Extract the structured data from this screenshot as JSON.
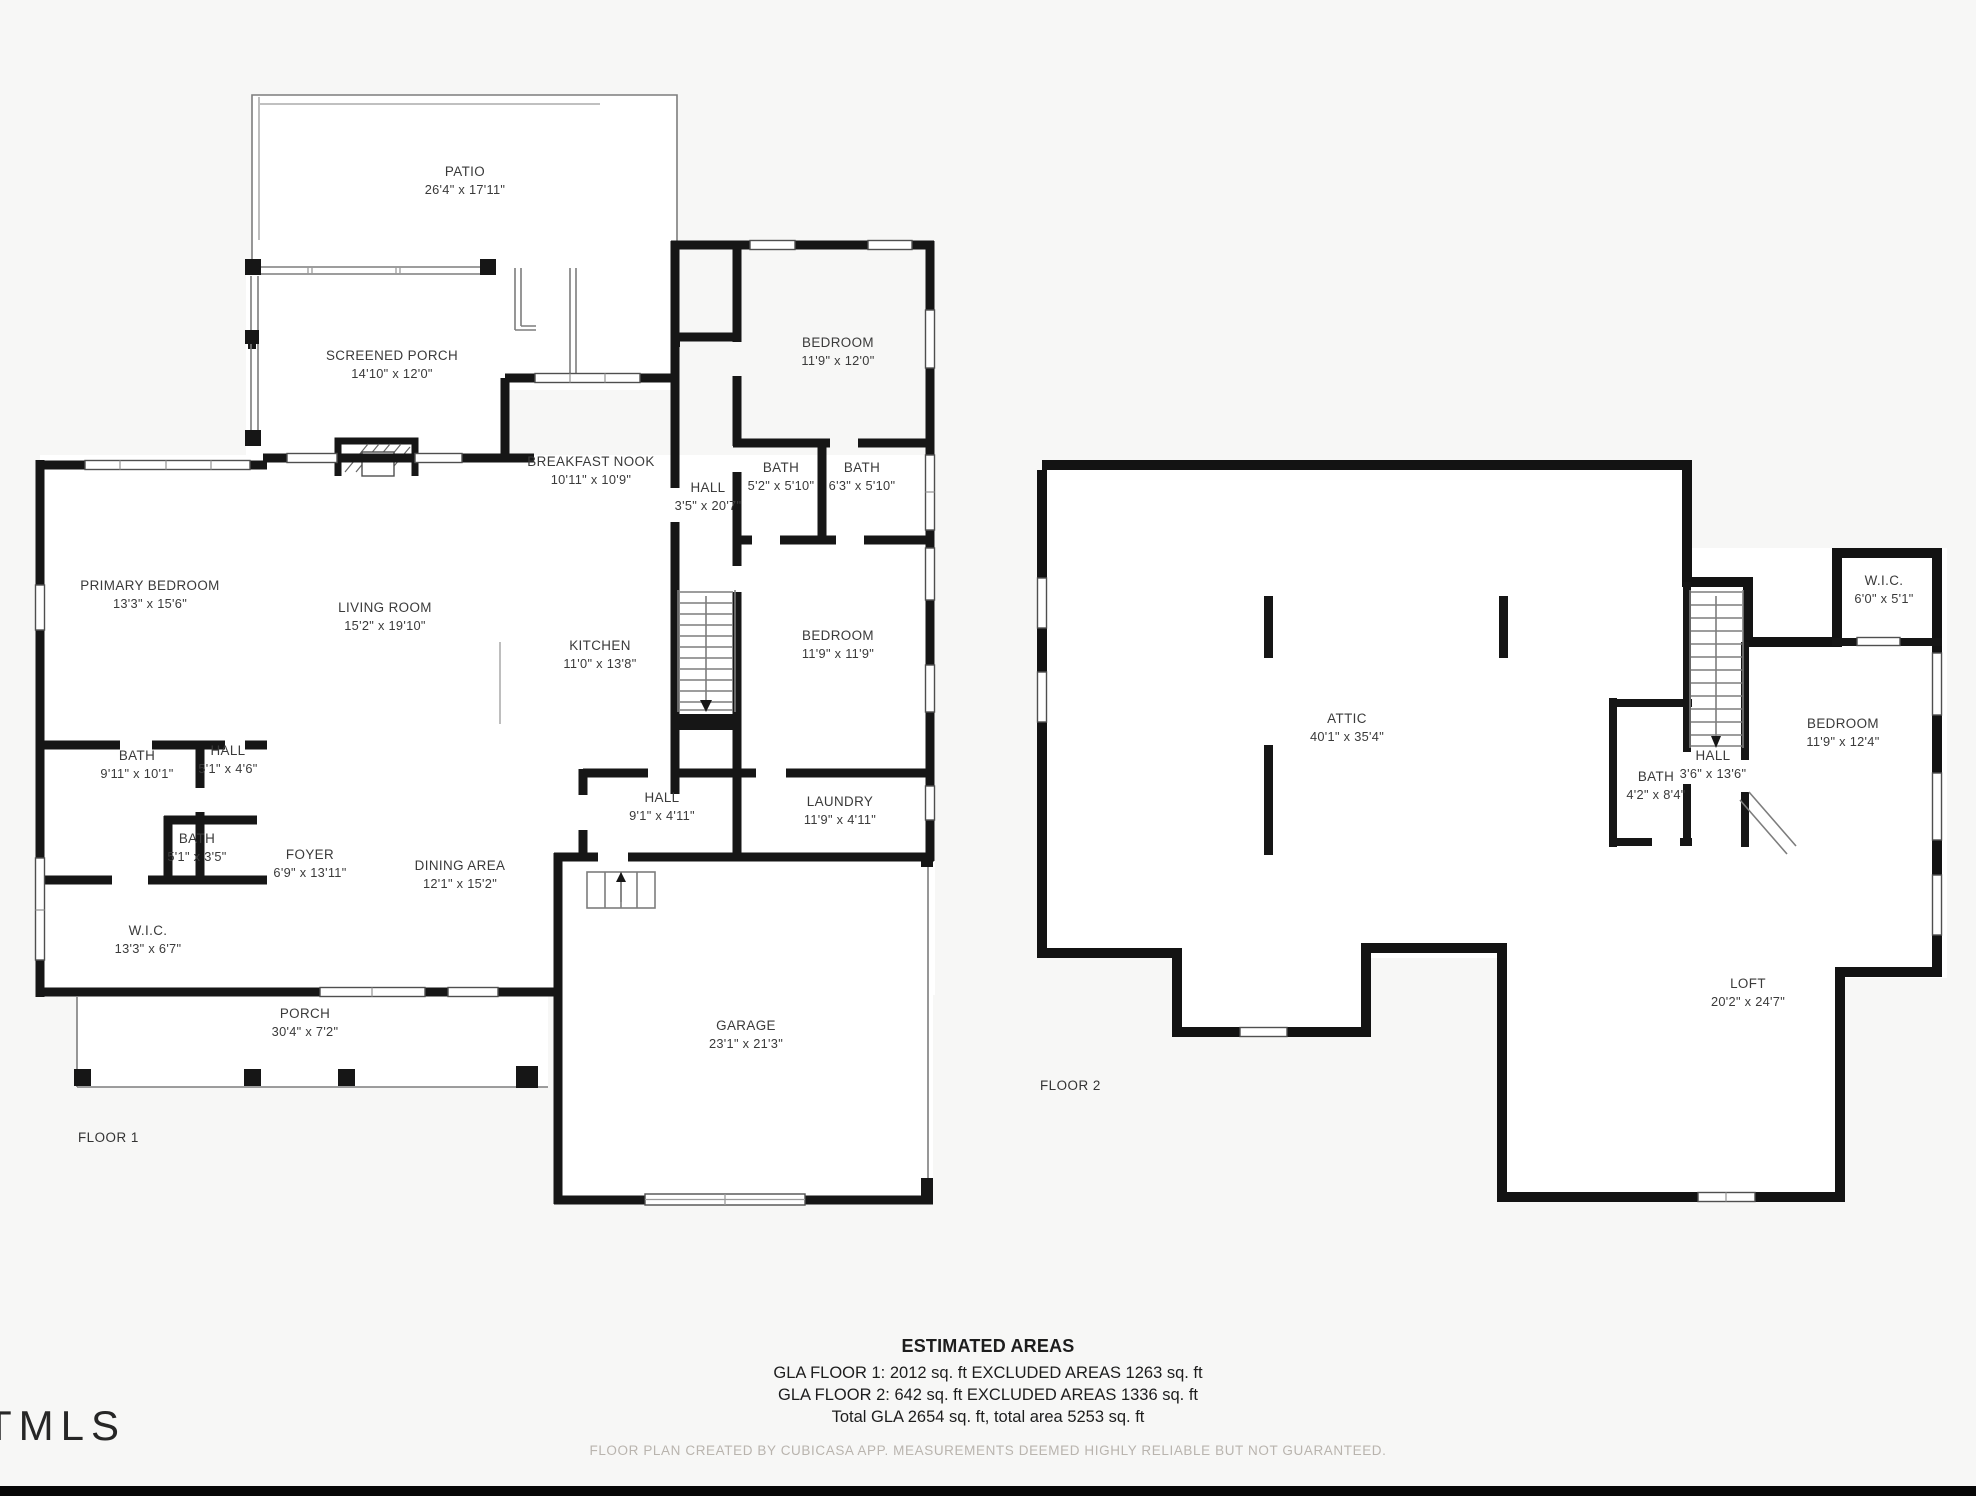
{
  "page": {
    "background": "#f7f7f6",
    "wall_color": "#161616",
    "bottom_bar_color": "#070707"
  },
  "logo": {
    "text": "TMLS"
  },
  "floor1": {
    "label": "FLOOR 1",
    "rooms": [
      {
        "name": "PATIO",
        "dims": "26'4\" x 17'11\""
      },
      {
        "name": "SCREENED PORCH",
        "dims": "14'10\" x 12'0\""
      },
      {
        "name": "BEDROOM",
        "dims": "11'9\" x 12'0\""
      },
      {
        "name": "BREAKFAST NOOK",
        "dims": "10'11\" x 10'9\""
      },
      {
        "name": "HALL",
        "dims": "3'5\" x 20'7\""
      },
      {
        "name": "BATH",
        "dims": "5'2\" x 5'10\""
      },
      {
        "name": "BATH",
        "dims": "6'3\" x 5'10\""
      },
      {
        "name": "PRIMARY BEDROOM",
        "dims": "13'3\" x 15'6\""
      },
      {
        "name": "LIVING ROOM",
        "dims": "15'2\" x 19'10\""
      },
      {
        "name": "KITCHEN",
        "dims": "11'0\" x 13'8\""
      },
      {
        "name": "BEDROOM",
        "dims": "11'9\" x 11'9\""
      },
      {
        "name": "BATH",
        "dims": "9'11\" x 10'1\""
      },
      {
        "name": "HALL",
        "dims": "5'1\" x 4'6\""
      },
      {
        "name": "BATH",
        "dims": "5'1\" x 3'5\""
      },
      {
        "name": "FOYER",
        "dims": "6'9\" x 13'11\""
      },
      {
        "name": "DINING AREA",
        "dims": "12'1\" x 15'2\""
      },
      {
        "name": "HALL",
        "dims": "9'1\" x 4'11\""
      },
      {
        "name": "LAUNDRY",
        "dims": "11'9\" x 4'11\""
      },
      {
        "name": "W.I.C.",
        "dims": "13'3\" x 6'7\""
      },
      {
        "name": "PORCH",
        "dims": "30'4\" x 7'2\""
      },
      {
        "name": "GARAGE",
        "dims": "23'1\" x 21'3\""
      }
    ]
  },
  "floor2": {
    "label": "FLOOR 2",
    "rooms": [
      {
        "name": "ATTIC",
        "dims": "40'1\" x 35'4\""
      },
      {
        "name": "W.I.C.",
        "dims": "6'0\" x 5'1\""
      },
      {
        "name": "BEDROOM",
        "dims": "11'9\" x 12'4\""
      },
      {
        "name": "BATH",
        "dims": "4'2\" x 8'4\""
      },
      {
        "name": "HALL",
        "dims": "3'6\" x 13'6\""
      },
      {
        "name": "LOFT",
        "dims": "20'2\" x 24'7\""
      }
    ]
  },
  "summary": {
    "title": "ESTIMATED AREAS",
    "line1": "GLA FLOOR 1: 2012 sq. ft EXCLUDED AREAS 1263 sq. ft",
    "line2": "GLA FLOOR 2: 642 sq. ft EXCLUDED AREAS 1336 sq. ft",
    "line3": "Total GLA 2654 sq. ft, total area 5253 sq. ft",
    "disclaimer": "FLOOR PLAN CREATED BY CUBICASA APP. MEASUREMENTS DEEMED HIGHLY RELIABLE BUT NOT GUARANTEED."
  }
}
